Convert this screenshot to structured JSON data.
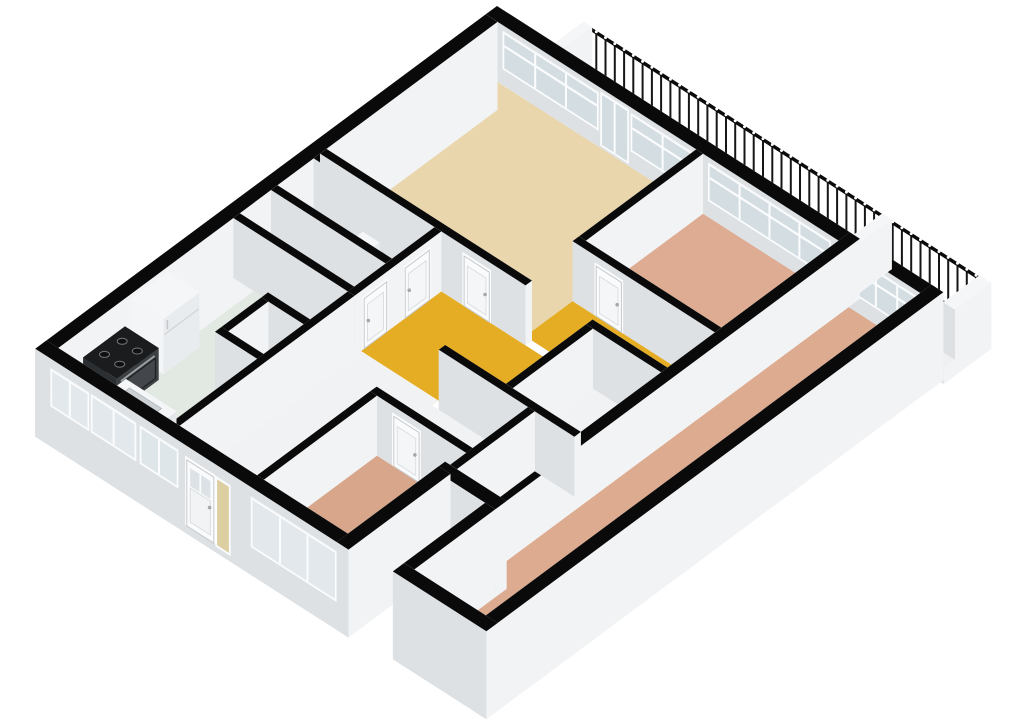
{
  "scene": {
    "canvas": {
      "width": 1024,
      "height": 724,
      "background": "#ffffff"
    },
    "projection": {
      "origin": [
        497,
        66
      ],
      "ex": [
        0.842,
        0.54
      ],
      "ey": [
        -0.803,
        0.596
      ],
      "wall_height": 60
    },
    "palette": {
      "cap": "#0a0a0b",
      "capWhite": "#f5f6f7",
      "faceS": "#dde1e4",
      "faceE": "#f2f3f4",
      "faceW": "#e7eaec",
      "faceN": "#eef0f1",
      "frame": "#fbfcfd",
      "glass": "#c9d4da",
      "glassFrost": "#d8dfe3",
      "slab": "#eef0f1"
    },
    "floors": [
      {
        "name": "balcony",
        "rect": [
          50,
          -45,
          538,
          0
        ],
        "color": "#f0f2f3"
      },
      {
        "name": "living-room",
        "rect": [
          14,
          14,
          250,
          227
        ],
        "color": "#e9d6ac"
      },
      {
        "name": "bedroom-middle",
        "rect": [
          258,
          14,
          419,
          160
        ],
        "color": "#ddac92"
      },
      {
        "name": "bedroom-east",
        "rect": [
          431,
          14,
          516,
          555
        ],
        "color": "#dcab90"
      },
      {
        "name": "hall-stub",
        "rect": [
          250,
          168,
          419,
          227
        ],
        "color": "#e5ad24"
      },
      {
        "name": "hall-main",
        "rect": [
          158,
          235,
          330,
          335
        ],
        "color": "#e5ad24"
      },
      {
        "name": "corridor-entry",
        "rect": [
          158,
          335,
          250,
          561
        ],
        "color": "#f1f2f3"
      },
      {
        "name": "hall-west-area",
        "rect": [
          250,
          343,
          364,
          412
        ],
        "color": "#f1f2f3"
      },
      {
        "name": "wc",
        "rect": [
          14,
          243,
          150,
          288
        ],
        "color": "#f1f2f3"
      },
      {
        "name": "bathroom",
        "rect": [
          14,
          296,
          150,
          335
        ],
        "color": "#f1f2f3"
      },
      {
        "name": "kitchen",
        "rect": [
          14,
          343,
          150,
          561
        ],
        "color": "#e2e9e3"
      },
      {
        "name": "meter-closet",
        "rect": [
          108,
          398,
          150,
          448
        ],
        "color": "#f1f2f3"
      },
      {
        "name": "closet-1",
        "rect": [
          338,
          235,
          419,
          335
        ],
        "color": "#f1f2f3"
      },
      {
        "name": "closet-2",
        "rect": [
          372,
          343,
          419,
          440
        ],
        "color": "#f1f2f3"
      },
      {
        "name": "bedroom-southwest",
        "rect": [
          258,
          420,
          358,
          561
        ],
        "color": "#d8a78b"
      }
    ],
    "walls": [
      {
        "name": "wall-ne",
        "rect": [
          0,
          0,
          530,
          14
        ],
        "zb": 0,
        "openings": [
          {
            "kind": "window",
            "face": "S",
            "from": 22,
            "to": 132,
            "z1": 18,
            "z2": 52,
            "mullions": 2,
            "transom": 40,
            "opacity": 0.78
          },
          {
            "kind": "glass-door",
            "face": "S",
            "from": 138,
            "to": 168,
            "z1": 4,
            "z2": 54,
            "mullions": 1,
            "opacity": 0.8
          },
          {
            "kind": "window",
            "face": "S",
            "from": 174,
            "to": 246,
            "z1": 18,
            "z2": 52,
            "mullions": 1,
            "transom": 40,
            "opacity": 0.78
          },
          {
            "kind": "window",
            "face": "S",
            "from": 266,
            "to": 408,
            "z1": 18,
            "z2": 52,
            "mullions": 3,
            "transom": 40,
            "opacity": 0.78
          },
          {
            "kind": "window",
            "face": "S",
            "from": 438,
            "to": 514,
            "z1": 18,
            "z2": 52,
            "mullions": 2,
            "transom": 40,
            "opacity": 0.78
          }
        ]
      },
      {
        "name": "wall-nw",
        "rect": [
          0,
          14,
          14,
          575
        ],
        "zb": -28
      },
      {
        "name": "wall-sw",
        "rect": [
          0,
          561,
          372,
          575
        ],
        "zb": -28,
        "openings": [
          {
            "kind": "window",
            "face": "S",
            "from": 20,
            "to": 62,
            "z1": 14,
            "z2": 48,
            "mullions": 1,
            "opacity": 0.5
          },
          {
            "kind": "window",
            "face": "S",
            "from": 68,
            "to": 118,
            "z1": 14,
            "z2": 48,
            "mullions": 1,
            "opacity": 0.5
          },
          {
            "kind": "window",
            "face": "S",
            "from": 126,
            "to": 168,
            "z1": 14,
            "z2": 48,
            "mullions": 1,
            "opacity": 0.55
          },
          {
            "kind": "door",
            "face": "S",
            "from": 180,
            "to": 212,
            "z1": -20,
            "z2": 46,
            "glass_top": true
          },
          {
            "kind": "window",
            "face": "S",
            "from": 216,
            "to": 230,
            "z1": -20,
            "z2": 46,
            "mullions": 0,
            "tint": "#d6c389",
            "opacity": 0.8
          },
          {
            "kind": "window",
            "face": "S",
            "from": 258,
            "to": 356,
            "z1": 2,
            "z2": 48,
            "mullions": 2,
            "opacity": 0.5
          }
        ]
      },
      {
        "name": "wall-bedroom-sw-east",
        "rect": [
          358,
          448,
          372,
          575
        ],
        "zb": -28
      },
      {
        "name": "wall-notch-north",
        "rect": [
          358,
          440,
          431,
          454
        ],
        "zb": -28
      },
      {
        "name": "wall-bedroom-east-west-north",
        "rect": [
          419,
          0,
          431,
          454
        ],
        "zb": 0
      },
      {
        "name": "wall-bedroom-east-west-south",
        "rect": [
          419,
          454,
          431,
          555
        ],
        "zb": -28
      },
      {
        "name": "wall-bedroom-east-south",
        "rect": [
          419,
          555,
          530,
          569
        ],
        "zb": -28
      },
      {
        "name": "wall-east",
        "rect": [
          516,
          0,
          530,
          569
        ],
        "zb": -28
      },
      {
        "name": "wall-living-east",
        "rect": [
          250,
          14,
          258,
          160
        ],
        "zb": 0
      },
      {
        "name": "wall-living-south",
        "rect": [
          14,
          227,
          258,
          235
        ],
        "zb": 0,
        "openings": [
          {
            "kind": "door",
            "face": "S",
            "from": 185,
            "to": 215,
            "z1": 0,
            "z2": 50
          }
        ]
      },
      {
        "name": "wall-bedroom-middle-south",
        "rect": [
          250,
          160,
          419,
          168
        ],
        "zb": 0,
        "openings": [
          {
            "kind": "door",
            "face": "S",
            "from": 278,
            "to": 308,
            "z1": 0,
            "z2": 50
          }
        ]
      },
      {
        "name": "wall-bath-north",
        "rect": [
          14,
          235,
          158,
          243
        ],
        "zb": 0
      },
      {
        "name": "wall-bath-east",
        "rect": [
          150,
          235,
          158,
          343
        ],
        "zb": 0,
        "openings": [
          {
            "kind": "door",
            "face": "E",
            "from": 250,
            "to": 280,
            "z1": 0,
            "z2": 50
          },
          {
            "kind": "door",
            "face": "E",
            "from": 303,
            "to": 331,
            "z1": 0,
            "z2": 50
          }
        ]
      },
      {
        "name": "wall-bath-divider",
        "rect": [
          14,
          288,
          150,
          296
        ],
        "zb": 0
      },
      {
        "name": "wall-bath-south",
        "rect": [
          14,
          335,
          158,
          343
        ],
        "zb": 0
      },
      {
        "name": "wall-kitchen-east",
        "rect": [
          150,
          343,
          158,
          561
        ],
        "zb": 0
      },
      {
        "name": "wall-closet1-west",
        "rect": [
          330,
          235,
          338,
          335
        ],
        "zb": 0
      },
      {
        "name": "wall-closet1-north",
        "rect": [
          330,
          227,
          419,
          235
        ],
        "zb": 0
      },
      {
        "name": "wall-hall-south",
        "rect": [
          258,
          335,
          419,
          343
        ],
        "zb": 0
      },
      {
        "name": "wall-closet2-west",
        "rect": [
          364,
          343,
          372,
          440
        ],
        "zb": 0
      },
      {
        "name": "wall-bedroom-sw-north",
        "rect": [
          250,
          412,
          372,
          420
        ],
        "zb": 0,
        "openings": [
          {
            "kind": "door",
            "face": "S",
            "from": 278,
            "to": 308,
            "z1": 0,
            "z2": 50
          }
        ]
      },
      {
        "name": "wall-bedroom-sw-west",
        "rect": [
          250,
          420,
          258,
          561
        ],
        "zb": 0
      },
      {
        "name": "wall-meter-north",
        "rect": [
          100,
          390,
          158,
          398
        ],
        "zb": 0
      },
      {
        "name": "wall-meter-west",
        "rect": [
          100,
          398,
          108,
          456
        ],
        "zb": 0
      },
      {
        "name": "wall-meter-south",
        "rect": [
          100,
          448,
          158,
          456
        ],
        "zb": 0
      }
    ],
    "balcony": {
      "slab": [
        50,
        -45,
        544,
        14
      ],
      "railing": {
        "x1": 64,
        "x2": 536,
        "y": -45,
        "step": 11,
        "post_height": 46,
        "post_color": "#161617",
        "rail_color": "#0b0b0c",
        "cap_color": "#ffffff",
        "base_color": "#2e2f30"
      },
      "partitions": [
        {
          "name": "balcony-partition-west",
          "rect": [
            60,
            -45,
            70,
            0
          ]
        },
        {
          "name": "balcony-partition-mid",
          "rect": [
            415,
            -45,
            426,
            0
          ]
        },
        {
          "name": "balcony-end-wall-east",
          "rect": [
            530,
            -45,
            544,
            0
          ]
        }
      ]
    },
    "fixtures": [
      {
        "type": "toilet",
        "name": "toilet",
        "tank": [
          79,
          250,
          99,
          262
        ],
        "bowl_center": [
          89,
          274
        ],
        "h": 26
      },
      {
        "type": "pipes",
        "name": "utility-pipes",
        "h": 58,
        "pipes": [
          {
            "x": 116,
            "y": 403,
            "color": "#9a5b3e"
          },
          {
            "x": 124,
            "y": 403,
            "color": "#8a4f34"
          },
          {
            "x": 134,
            "y": 403,
            "color": "#2c2c2e"
          },
          {
            "x": 142,
            "y": 403,
            "color": "#2c2c2e"
          }
        ]
      },
      {
        "type": "fridge",
        "name": "refrigerator",
        "rect": [
          14,
          425,
          52,
          470
        ],
        "h": 55
      },
      {
        "type": "stove",
        "name": "stove",
        "rect": [
          14,
          478,
          54,
          530
        ],
        "h": 32
      },
      {
        "type": "sink",
        "name": "kitchen-sink",
        "rect": [
          58,
          523,
          118,
          559
        ],
        "h": 30
      }
    ]
  }
}
